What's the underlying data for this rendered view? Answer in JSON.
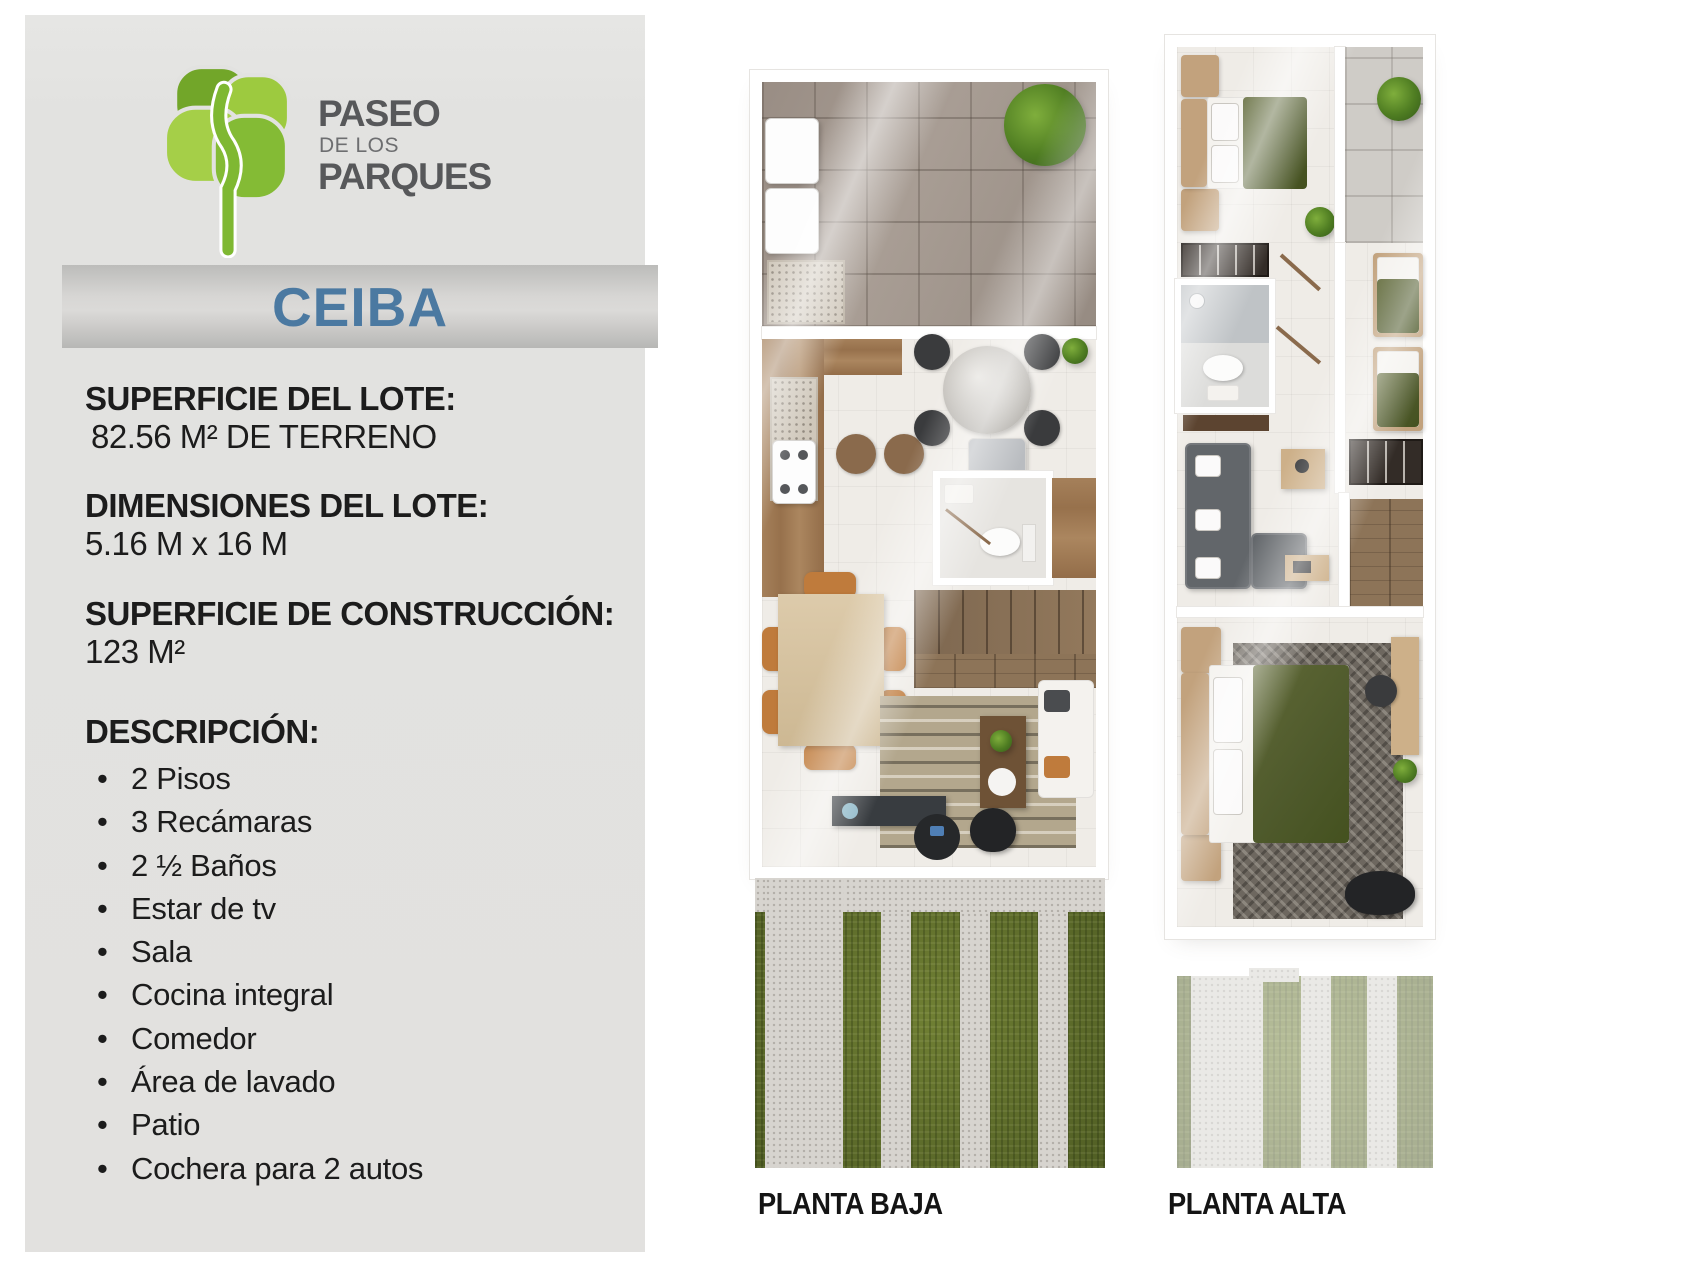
{
  "brand": {
    "logo_text_top": "PASEO",
    "logo_text_mid": "DE LOS",
    "logo_text_bottom": "PARQUES",
    "logo_green_light": "#a5cf48",
    "logo_green_dark": "#72a629",
    "logo_trunk_green": "#7fb832",
    "logo_text_color": "#57585a"
  },
  "model": {
    "name": "CEIBA",
    "accent_color": "#4b79a1"
  },
  "specs": [
    {
      "label": "SUPERFICIE DEL LOTE:",
      "value": "82.56 M² DE TERRENO"
    },
    {
      "label": "DIMENSIONES DEL LOTE:",
      "value": "5.16 M x 16 M"
    },
    {
      "label": "SUPERFICIE DE CONSTRUCCIÓN:",
      "value": "123 M²"
    }
  ],
  "description": {
    "title": "DESCRIPCIÓN:",
    "items": [
      "2 Pisos",
      "3 Recámaras",
      "2 ½ Baños",
      "Estar de tv",
      "Sala",
      "Cocina integral",
      "Comedor",
      "Área de lavado",
      "Patio",
      "Cochera para 2 autos"
    ]
  },
  "plans": [
    {
      "label": "PLANTA BAJA"
    },
    {
      "label": "PLANTA ALTA"
    }
  ],
  "palette": {
    "panel_bg": "#e2e2e0",
    "banner_gray": "#c9c8c6",
    "text": "#1c1c1c",
    "grass": "#66732f",
    "concrete": "#d7d4cf",
    "wood": "#a5805a",
    "stone_tile": "#a0958c",
    "bed_olive": "#4f5a2c",
    "floor_light": "#efece7"
  }
}
